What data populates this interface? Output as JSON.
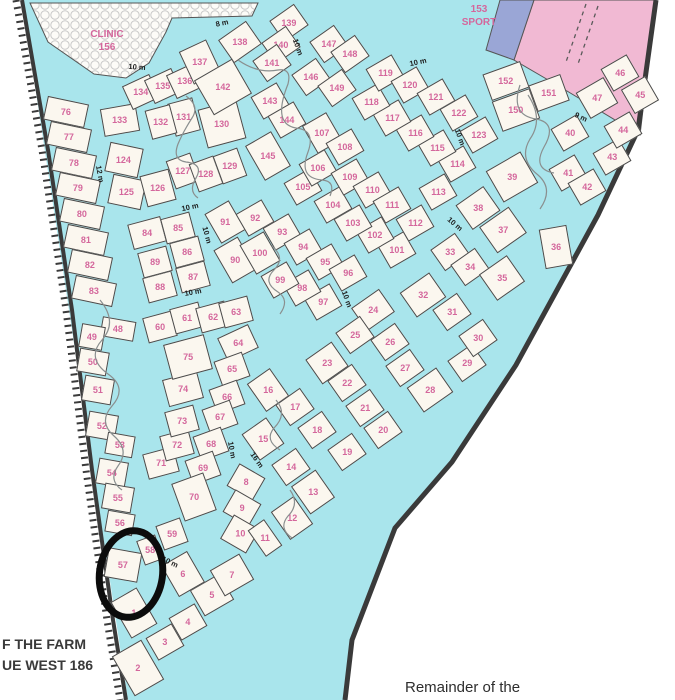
{
  "map": {
    "colors": {
      "water": "#a9e5ec",
      "plot_fill": "#fbf7ef",
      "plot_border": "#4a4a4a",
      "number": "#d4679c",
      "sport_pink": "#f1b9d3",
      "blue_area": "#9aa6d6",
      "boundary": "#3a3a3a",
      "clinic_circle": "#c9c9c9"
    },
    "areas": {
      "clinic": {
        "name": "CLINIC",
        "number": "156"
      },
      "sport": {
        "number": "153",
        "name": "SPORT"
      }
    },
    "texts": {
      "farm_line1": "F THE FARM",
      "farm_line2": "UE WEST 186",
      "remainder": "Remainder of the"
    },
    "highlighted_plot": "57",
    "plots": [
      [
        1,
        134,
        613,
        -30,
        30,
        42
      ],
      [
        2,
        138,
        668,
        -30,
        34,
        46
      ],
      [
        3,
        165,
        642,
        -30
      ],
      [
        4,
        188,
        622,
        -30
      ],
      [
        5,
        212,
        595,
        -30,
        34,
        30
      ],
      [
        6,
        183,
        574,
        -30,
        30,
        36
      ],
      [
        7,
        232,
        575,
        -30,
        34,
        30
      ],
      [
        8,
        246,
        482,
        -60,
        26,
        30
      ],
      [
        9,
        242,
        508,
        -60,
        26,
        30
      ],
      [
        10,
        240,
        534,
        -60,
        28,
        30
      ],
      [
        11,
        265,
        538,
        -35,
        20,
        32
      ],
      [
        12,
        292,
        518,
        -35,
        28,
        34
      ],
      [
        13,
        313,
        492,
        -35,
        30,
        34
      ],
      [
        14,
        291,
        467,
        -35
      ],
      [
        15,
        263,
        439,
        -35,
        30,
        32
      ],
      [
        16,
        268,
        390,
        -35,
        28,
        34
      ],
      [
        17,
        295,
        407,
        -35
      ],
      [
        18,
        317,
        430,
        -35
      ],
      [
        19,
        347,
        452,
        -35
      ],
      [
        20,
        383,
        430,
        -35
      ],
      [
        21,
        365,
        408,
        -35
      ],
      [
        22,
        347,
        383,
        -35
      ],
      [
        23,
        327,
        363,
        -35,
        32,
        30
      ],
      [
        24,
        373,
        310,
        -35,
        34,
        28
      ],
      [
        25,
        355,
        335,
        -35
      ],
      [
        26,
        390,
        342,
        -35
      ],
      [
        27,
        405,
        368,
        -35
      ],
      [
        28,
        430,
        390,
        -35,
        36,
        30
      ],
      [
        29,
        467,
        363,
        -35
      ],
      [
        30,
        478,
        338,
        -35
      ],
      [
        31,
        452,
        312,
        -35
      ],
      [
        32,
        423,
        295,
        -35,
        36,
        30
      ],
      [
        33,
        450,
        252,
        -35
      ],
      [
        34,
        470,
        267,
        -35
      ],
      [
        35,
        502,
        278,
        -35,
        34,
        32
      ],
      [
        36,
        556,
        247,
        -10,
        28,
        40
      ],
      [
        37,
        503,
        230,
        -35,
        36,
        32
      ],
      [
        38,
        478,
        208,
        -35,
        34,
        30
      ],
      [
        39,
        512,
        177,
        -30,
        40,
        36
      ],
      [
        40,
        570,
        133,
        -30
      ],
      [
        41,
        568,
        173,
        -30
      ],
      [
        42,
        587,
        187,
        -30
      ],
      [
        43,
        612,
        157,
        -30
      ],
      [
        44,
        623,
        130,
        -30
      ],
      [
        45,
        640,
        95,
        -30,
        28,
        28
      ],
      [
        46,
        620,
        73,
        -30
      ],
      [
        47,
        597,
        98,
        -30,
        32,
        30
      ],
      [
        48,
        118,
        329,
        10,
        34,
        20
      ],
      [
        49,
        92,
        337,
        10,
        24,
        24
      ],
      [
        50,
        93,
        362,
        10,
        30,
        24
      ],
      [
        51,
        98,
        390,
        10,
        30,
        26
      ],
      [
        52,
        102,
        426,
        10,
        30,
        26
      ],
      [
        53,
        120,
        445,
        10,
        28,
        22
      ],
      [
        54,
        112,
        473,
        10,
        30,
        26
      ],
      [
        55,
        118,
        498,
        10,
        30,
        26
      ],
      [
        56,
        120,
        523,
        10,
        28,
        22
      ],
      [
        57,
        123,
        565,
        10,
        34,
        30
      ],
      [
        58,
        150,
        550,
        -20,
        20,
        26
      ],
      [
        59,
        172,
        534,
        -20,
        26,
        26
      ],
      [
        60,
        160,
        327,
        -15
      ],
      [
        61,
        187,
        318,
        -15
      ],
      [
        62,
        213,
        317,
        -15
      ],
      [
        63,
        236,
        312,
        -15
      ],
      [
        64,
        238,
        343,
        -25,
        34,
        26
      ],
      [
        65,
        232,
        369,
        -20
      ],
      [
        66,
        227,
        397,
        -20
      ],
      [
        67,
        220,
        417,
        -20
      ],
      [
        68,
        211,
        444,
        -20
      ],
      [
        69,
        203,
        468,
        -20
      ],
      [
        70,
        194,
        497,
        -20,
        34,
        40
      ],
      [
        71,
        161,
        463,
        -15,
        32,
        26
      ],
      [
        72,
        177,
        445,
        -15
      ],
      [
        73,
        182,
        421,
        -15
      ],
      [
        74,
        183,
        389,
        -15,
        36,
        28
      ],
      [
        75,
        188,
        357,
        -15,
        42,
        36
      ],
      [
        76,
        66,
        112,
        12,
        42,
        24
      ],
      [
        77,
        69,
        137,
        12,
        42,
        24
      ],
      [
        78,
        74,
        163,
        12,
        42,
        24
      ],
      [
        79,
        78,
        188,
        12,
        42,
        24
      ],
      [
        80,
        82,
        214,
        12,
        42,
        24
      ],
      [
        81,
        86,
        240,
        12,
        42,
        24
      ],
      [
        82,
        90,
        265,
        12,
        42,
        24
      ],
      [
        83,
        94,
        291,
        12,
        42,
        24
      ],
      [
        84,
        147,
        233,
        -15,
        34,
        26
      ],
      [
        85,
        178,
        228,
        -15
      ],
      [
        86,
        187,
        252,
        -15
      ],
      [
        87,
        193,
        277,
        -15
      ],
      [
        88,
        160,
        287,
        -15
      ],
      [
        89,
        155,
        262,
        -15
      ],
      [
        90,
        235,
        260,
        -30,
        28,
        38
      ],
      [
        91,
        225,
        222,
        -30,
        28,
        34
      ],
      [
        92,
        255,
        218,
        -30
      ],
      [
        93,
        282,
        232,
        -30
      ],
      [
        94,
        303,
        247,
        -30
      ],
      [
        95,
        325,
        262,
        -30
      ],
      [
        96,
        348,
        273,
        -30
      ],
      [
        97,
        323,
        302,
        -30
      ],
      [
        98,
        302,
        288,
        -30
      ],
      [
        99,
        280,
        280,
        -30
      ],
      [
        100,
        260,
        253,
        -30,
        28,
        34
      ],
      [
        101,
        397,
        250,
        -30
      ],
      [
        102,
        375,
        235,
        -30
      ],
      [
        103,
        353,
        223,
        -30
      ],
      [
        104,
        333,
        205,
        -30
      ],
      [
        105,
        303,
        187,
        -30
      ],
      [
        106,
        318,
        168,
        -30
      ],
      [
        107,
        322,
        133,
        -30,
        28,
        32
      ],
      [
        108,
        345,
        147,
        -30
      ],
      [
        109,
        350,
        177,
        -30
      ],
      [
        110,
        372,
        190,
        -30
      ],
      [
        111,
        392,
        205,
        -30
      ],
      [
        112,
        415,
        223,
        -30
      ],
      [
        113,
        438,
        192,
        -30
      ],
      [
        114,
        457,
        164,
        -30
      ],
      [
        115,
        437,
        148,
        -30
      ],
      [
        116,
        415,
        133,
        -30
      ],
      [
        117,
        392,
        118,
        -30
      ],
      [
        118,
        371,
        102,
        -30
      ],
      [
        119,
        385,
        73,
        -30
      ],
      [
        120,
        410,
        85,
        -30
      ],
      [
        121,
        436,
        97,
        -30
      ],
      [
        122,
        459,
        113,
        -30
      ],
      [
        123,
        479,
        135,
        -30
      ],
      [
        124,
        124,
        160,
        12,
        34,
        30
      ],
      [
        125,
        127,
        192,
        12,
        34,
        30
      ],
      [
        126,
        158,
        188,
        -15,
        30,
        32
      ],
      [
        127,
        183,
        171,
        -20,
        26,
        30
      ],
      [
        128,
        206,
        174,
        -20,
        26,
        30
      ],
      [
        129,
        230,
        166,
        -20,
        26,
        30
      ],
      [
        130,
        222,
        124,
        -15,
        40,
        40
      ],
      [
        131,
        184,
        117,
        -15,
        26,
        34
      ],
      [
        132,
        161,
        122,
        -15,
        26,
        30
      ],
      [
        133,
        120,
        120,
        -10,
        36,
        28
      ],
      [
        134,
        141,
        92,
        -25
      ],
      [
        135,
        163,
        86,
        -25
      ],
      [
        136,
        185,
        81,
        -25
      ],
      [
        137,
        200,
        62,
        -25,
        30,
        36
      ],
      [
        138,
        240,
        42,
        -35,
        34,
        28
      ],
      [
        139,
        289,
        23,
        -35
      ],
      [
        140,
        281,
        45,
        -35
      ],
      [
        141,
        272,
        63,
        -35
      ],
      [
        142,
        223,
        87,
        -30,
        44,
        40
      ],
      [
        143,
        270,
        101,
        -30
      ],
      [
        144,
        287,
        120,
        -30
      ],
      [
        145,
        268,
        156,
        -30,
        30,
        40
      ],
      [
        146,
        311,
        77,
        -35
      ],
      [
        147,
        329,
        44,
        -35
      ],
      [
        148,
        350,
        54,
        -35
      ],
      [
        149,
        337,
        88,
        -35
      ],
      [
        150,
        516,
        110,
        -20,
        40,
        32
      ],
      [
        151,
        549,
        93,
        -20,
        34,
        28
      ],
      [
        152,
        506,
        81,
        -20,
        40,
        28
      ]
    ],
    "street_labels": [
      [
        "8 m",
        222,
        23,
        -12
      ],
      [
        "10 m",
        137,
        67,
        4
      ],
      [
        "10 m",
        298,
        47,
        70
      ],
      [
        "10 m",
        418,
        62,
        -12
      ],
      [
        "9 m",
        581,
        117,
        25
      ],
      [
        "12 m",
        100,
        174,
        80
      ],
      [
        "10 m",
        190,
        207,
        -12
      ],
      [
        "10 m",
        207,
        235,
        75
      ],
      [
        "10 m",
        193,
        292,
        -10
      ],
      [
        "10 m",
        455,
        224,
        40
      ],
      [
        "10 m",
        460,
        137,
        70
      ],
      [
        "10 m",
        347,
        299,
        70
      ],
      [
        "10 m",
        232,
        450,
        80
      ],
      [
        "16 m",
        257,
        460,
        55
      ],
      [
        "10 m",
        170,
        562,
        25
      ]
    ]
  }
}
